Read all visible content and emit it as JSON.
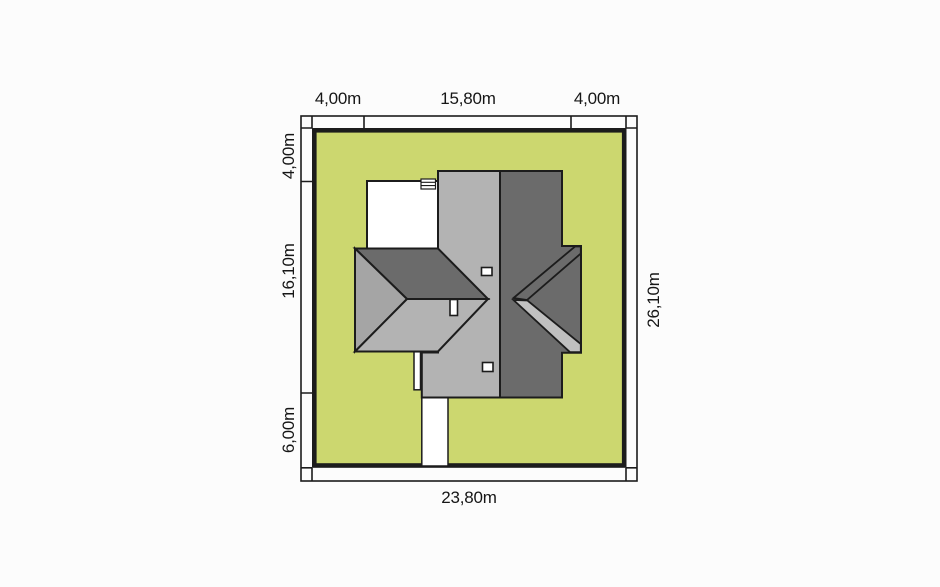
{
  "plan": {
    "dimensions": {
      "top": [
        "4,00m",
        "15,80m",
        "4,00m"
      ],
      "left": [
        "4,00m",
        "16,10m",
        "6,00m"
      ],
      "right": "26,10m",
      "bottom": "23,80m"
    },
    "colors": {
      "background": "#fcfcfc",
      "plot_fill": "#ccd76f",
      "roof_light": "#b3b3b3",
      "roof_medium": "#a5a5a5",
      "roof_dark": "#6b6b6b",
      "roof_band_light": "#c0c0c0",
      "paving_white": "#ffffff",
      "outline": "#1c1c1c"
    }
  }
}
